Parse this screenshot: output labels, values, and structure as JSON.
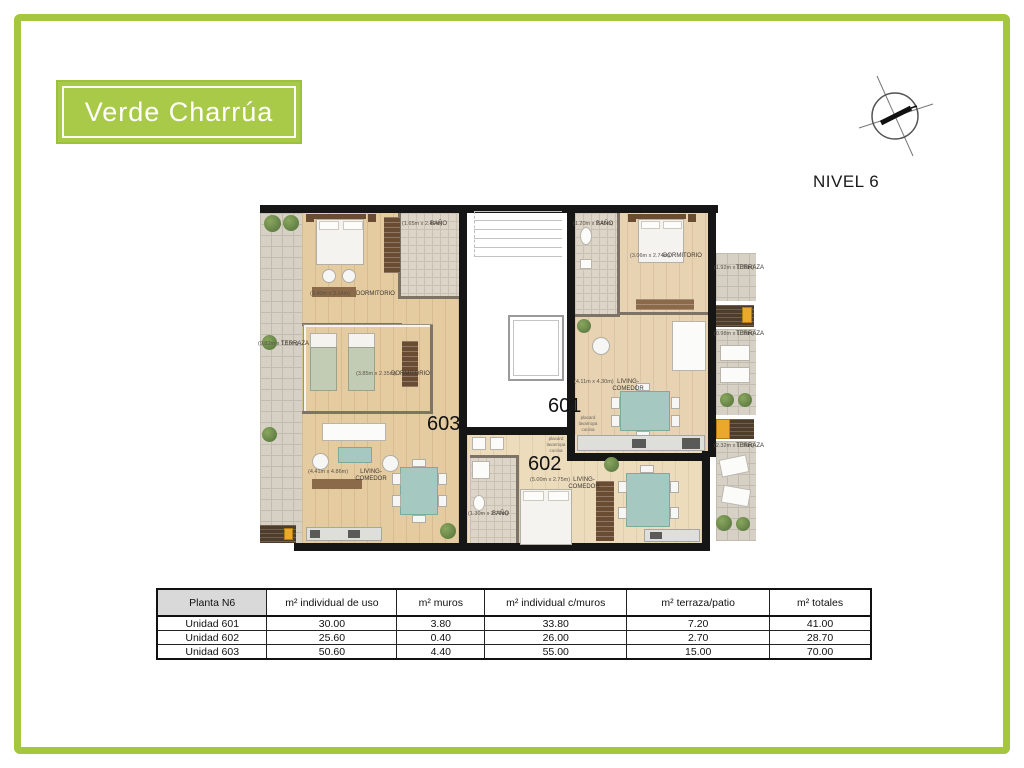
{
  "brand": {
    "name": "Verde Charrúa"
  },
  "plan": {
    "level_label": "NIVEL 6"
  },
  "colors": {
    "frame_green": "#a4c73e",
    "logo_green": "#a9ca48",
    "wall_black": "#161616",
    "wood_floor": "#e4cba0",
    "terrace_tile": "#d6d1c4",
    "table_teal": "#a5c9c0"
  },
  "units": {
    "u601": "601",
    "u602": "602",
    "u603": "603"
  },
  "rooms": {
    "terraza_left": {
      "name": "TERRAZA",
      "dims": "(9.82m x 1.15m)"
    },
    "dorm603a": {
      "name": "DORMITORIO",
      "dims": "(3.40m x 3.14m)"
    },
    "bano603": {
      "name": "BAÑO",
      "dims": "(1.65m x 2.49m)"
    },
    "dorm603b": {
      "name": "DORMITORIO",
      "dims": "(3.85m x 2.35m)"
    },
    "living603": {
      "name": "LIVING-COMEDOR",
      "dims": "(4.41m x 4.86m)"
    },
    "bano601": {
      "name": "BAÑO",
      "dims": "(1.20m x 2.49m)"
    },
    "dorm601": {
      "name": "DORMITORIO",
      "dims": "(3.06m x 2.74m)"
    },
    "living601": {
      "name": "LIVING-COMEDOR",
      "dims": "(4.11m x 4.30m)"
    },
    "living602": {
      "name": "LIVING-COMEDOR",
      "dims": "(5.00m x 2.75m)"
    },
    "bano602": {
      "name": "BAÑO",
      "dims": "(1.30m x 2.79m)"
    },
    "terraza_r1": {
      "name": "TERRAZA",
      "dims": "(1.92m x 1.20m)"
    },
    "terraza_r2": {
      "name": "TERRAZA",
      "dims": "(0.98m x 1.29m)"
    },
    "terraza_r3": {
      "name": "TERRAZA",
      "dims": "(2.32m x 1.26m)"
    }
  },
  "annotations": {
    "placard_601": "placard\nlavarropa\ncocina",
    "placard_602": "placard\nlavarropa\ncocina"
  },
  "table": {
    "headers": [
      "Planta N6",
      "m² individual de uso",
      "m² muros",
      "m² individual c/muros",
      "m² terraza/patio",
      "m² totales"
    ],
    "rows": [
      {
        "cells": [
          "Unidad 601",
          "30.00",
          "3.80",
          "33.80",
          "7.20",
          "41.00"
        ]
      },
      {
        "cells": [
          "Unidad 602",
          "25.60",
          "0.40",
          "26.00",
          "2.70",
          "28.70"
        ]
      },
      {
        "cells": [
          "Unidad 603",
          "50.60",
          "4.40",
          "55.00",
          "15.00",
          "70.00"
        ]
      }
    ]
  }
}
